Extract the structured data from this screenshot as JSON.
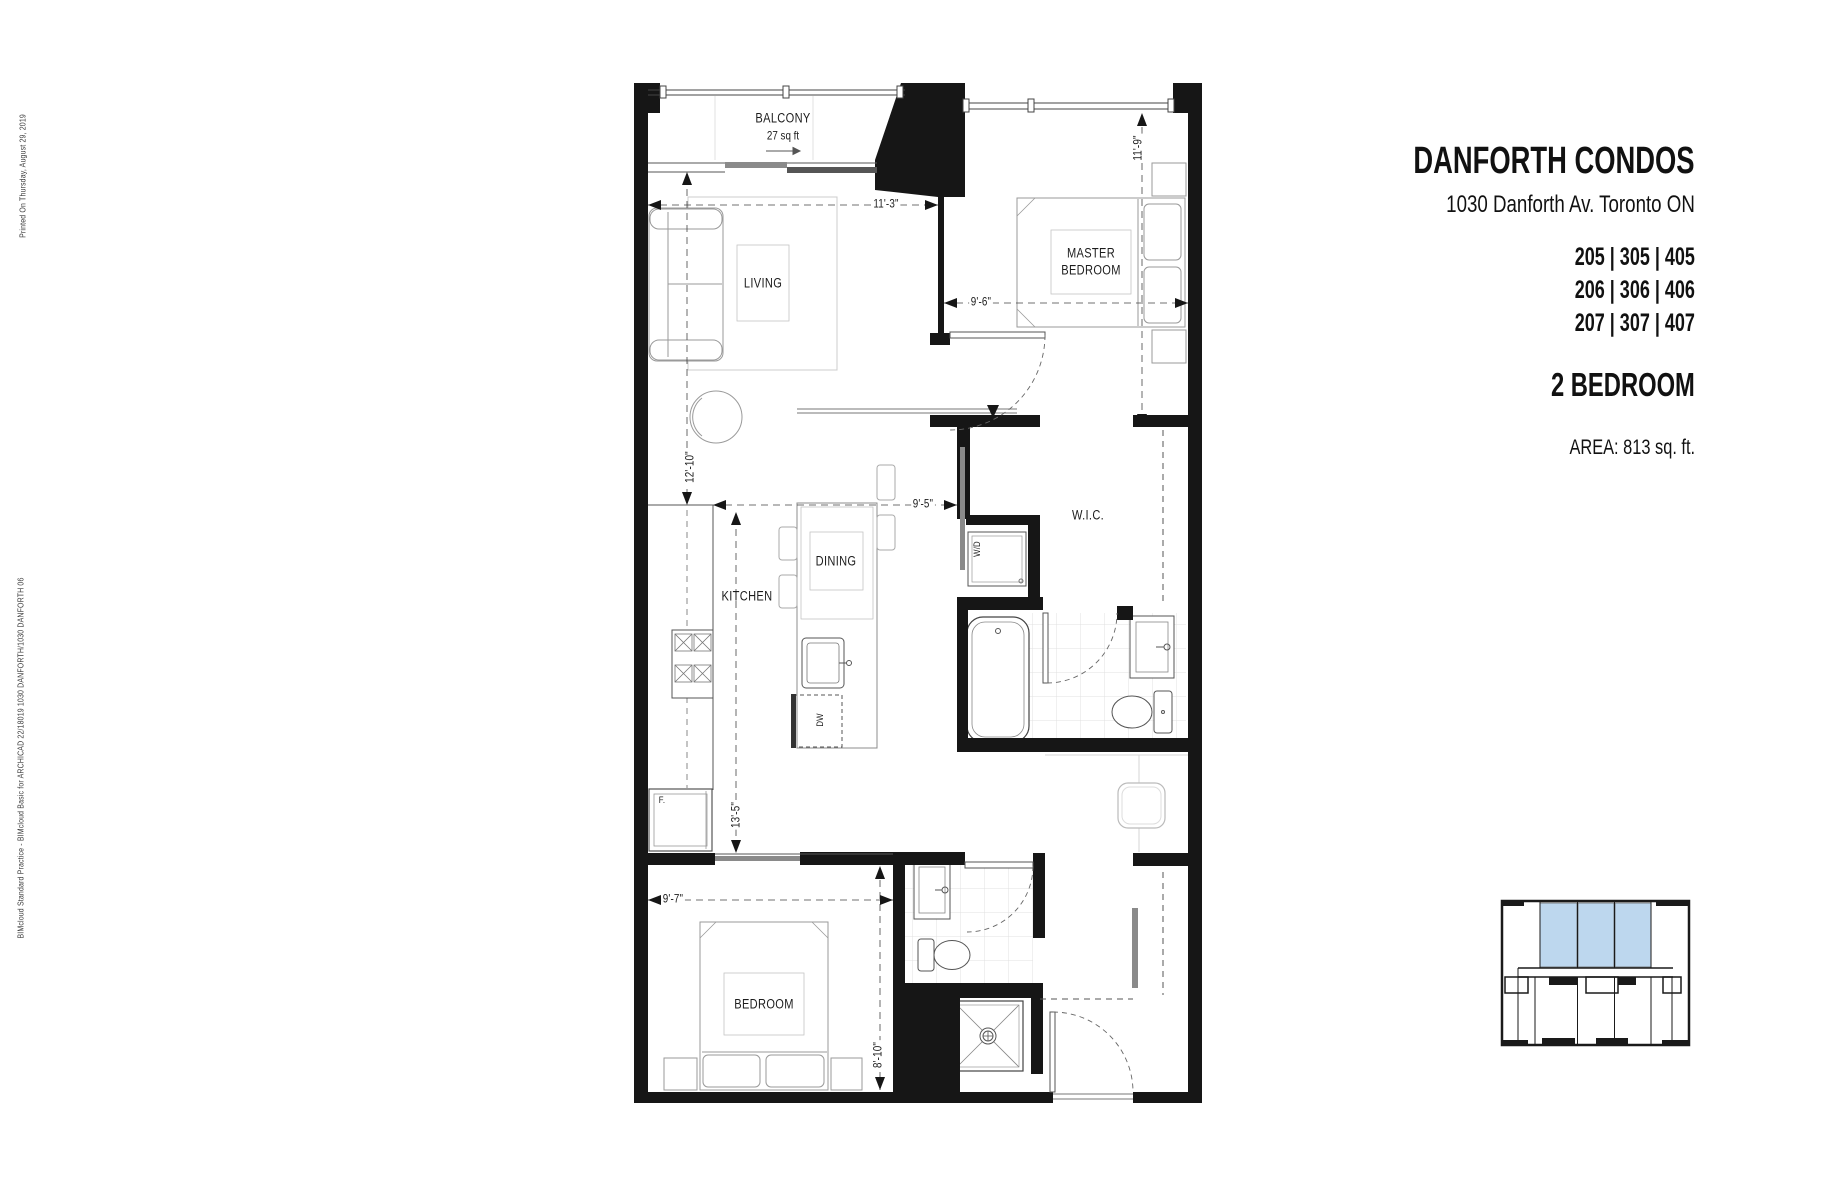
{
  "title_block": {
    "project": "DANFORTH CONDOS",
    "address": "1030 Danforth Av. Toronto ON",
    "stack_1": "205 | 305 | 405",
    "stack_2": "206 | 306 | 406",
    "stack_3": "207 | 307 | 407",
    "suite_type": "2 BEDROOM",
    "area": "AREA: 813 sq. ft."
  },
  "margin_notes": {
    "printed_on": "Printed On  Thursday, August 29, 2019",
    "bim": "BIMcloud  Standard Practice - BIMcloud Basic for ARCHICAD 22/18019 1030 DANFORTH/1030 DANFORTH 06"
  },
  "rooms": {
    "balcony": "BALCONY",
    "balcony_area": "27 sq ft",
    "living": "LIVING",
    "master_bedroom": "MASTER\nBEDROOM",
    "kitchen": "KITCHEN",
    "dining": "DINING",
    "wic": "W.I.C.",
    "bedroom": "BEDROOM"
  },
  "appliances": {
    "washer_dryer": "W/D",
    "dishwasher": "DW",
    "fridge": "F."
  },
  "dimensions": {
    "living_width": "11'-3\"",
    "living_depth": "12'-10\"",
    "master_width": "9'-6\"",
    "master_depth": "11'-9\"",
    "hall_width": "9'-5\"",
    "kitchen_run": "13'-5\"",
    "bedroom_width": "9'-7\"",
    "bedroom_depth": "8'-10\""
  },
  "colors": {
    "wall": "#161616",
    "keyplan_highlight": "#bdd7ee"
  }
}
